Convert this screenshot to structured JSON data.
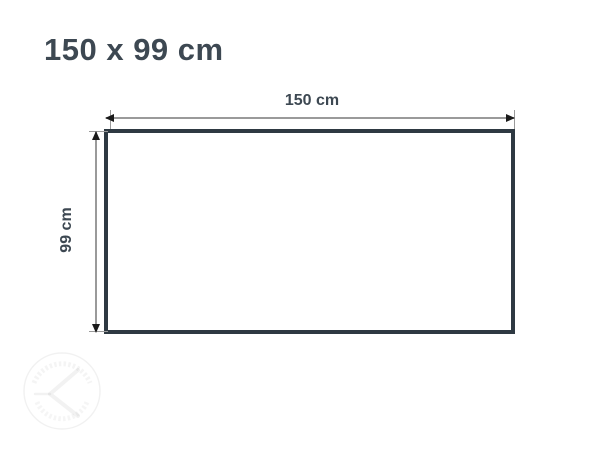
{
  "title": {
    "text": "150 x 99 cm"
  },
  "diagram": {
    "type": "rectangle-dimension-diagram",
    "width_label": "150 cm",
    "height_label": "99 cm",
    "width_cm": 150,
    "height_cm": 99
  },
  "colors": {
    "background": "#ffffff",
    "title_text": "#3d4852",
    "dimension_label_text": "#3d4852",
    "rectangle_border": "#2e3942",
    "dimension_line": "#9a9a9a",
    "arrowhead": "#1a1a1a",
    "watermark": "rgba(0,0,0,0.05)"
  },
  "watermark": {
    "icon": "circular-stamp-watermark"
  }
}
